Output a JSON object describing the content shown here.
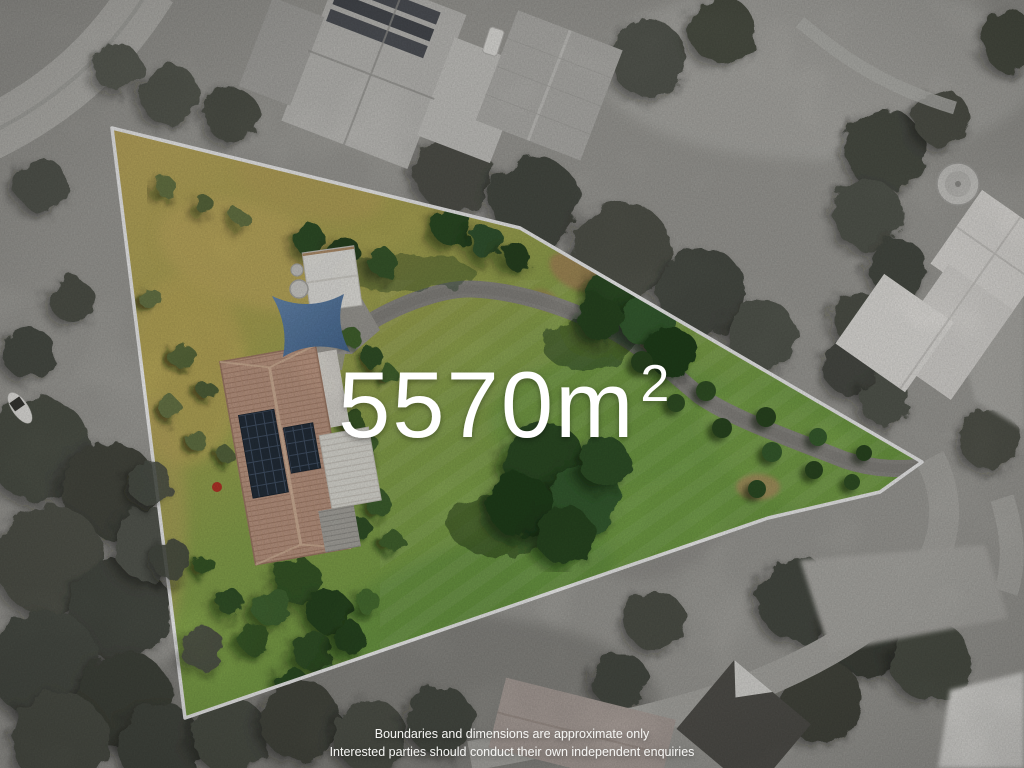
{
  "overlay": {
    "area_value": "5570m",
    "area_superscript": "2",
    "disclaimer_line1": "Boundaries and dimensions are approximate only",
    "disclaimer_line2": "Interested parties should conduct their own independent enquiries"
  },
  "colors": {
    "boundary_line": "#ffffff",
    "overlay_text": "#ffffff",
    "lot_grass_green": "#7ba649",
    "lot_grass_dry": "#c6b060",
    "house_roof_terracotta": "#c9a28c",
    "solar_panel_dark": "#26313d",
    "shade_sail_blue": "#5a7ea8",
    "shed_roof_white": "#f3f2ed",
    "driveway_asphalt": "#93918c",
    "surround_grayscale": "#a6a5a0"
  }
}
